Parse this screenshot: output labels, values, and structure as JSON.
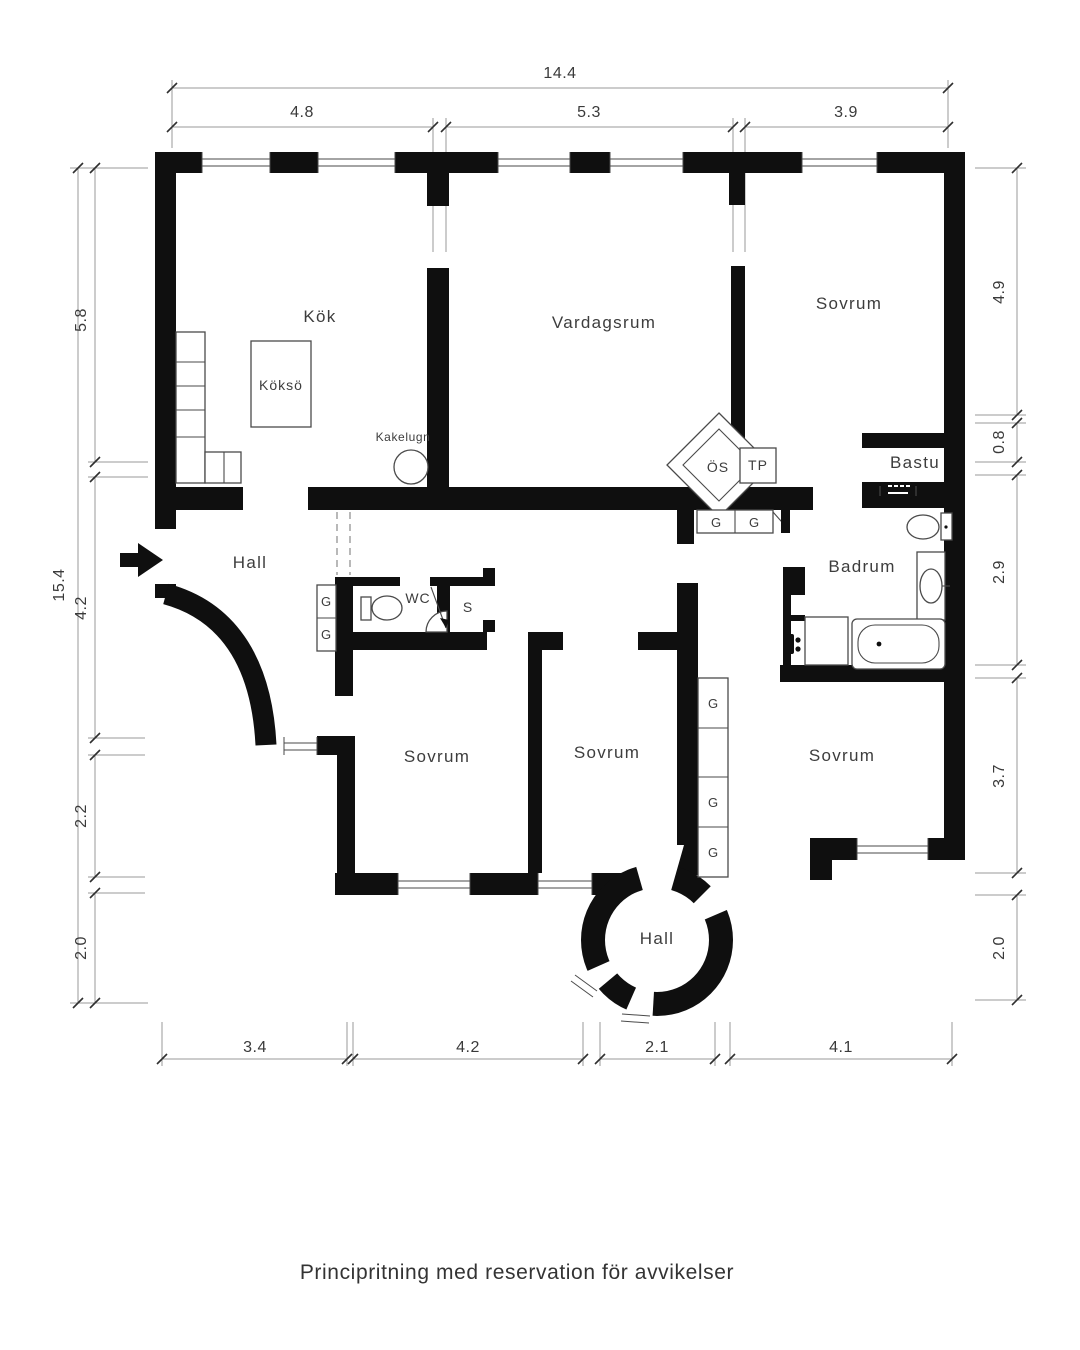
{
  "caption": "Principritning med reservation för avvikelser",
  "rooms": {
    "kok": "Kök",
    "kokso": "Köksö",
    "kakelugn": "Kakelugn",
    "vardagsrum": "Vardagsrum",
    "sovrum_ne": "Sovrum",
    "bastu": "Bastu",
    "hall": "Hall",
    "wc": "WC",
    "s": "S",
    "badrum": "Badrum",
    "os": "ÖS",
    "tp": "TP",
    "g": "G",
    "sovrum_sw": "Sovrum",
    "sovrum_sm": "Sovrum",
    "sovrum_se": "Sovrum",
    "hall_round": "Hall"
  },
  "dimensions": {
    "top": {
      "overall": "14.4",
      "segments": [
        "4.8",
        "5.3",
        "3.9"
      ]
    },
    "left": {
      "overall": "15.4",
      "segments": [
        "5.8",
        "4.2",
        "2.2",
        "2.0"
      ]
    },
    "right": {
      "segments": [
        "4.9",
        "0.8",
        "2.9",
        "3.7",
        "2.0"
      ]
    },
    "bottom": {
      "segments": [
        "3.4",
        "4.2",
        "2.1",
        "4.1"
      ]
    }
  },
  "colors": {
    "wall": "#0f0f0f",
    "label": "#3d3d3d",
    "dimtext": "#3a3a3a",
    "dimline": "#9a9a9a",
    "tick": "#2f2f2f",
    "outline": "#4a4a4a"
  }
}
